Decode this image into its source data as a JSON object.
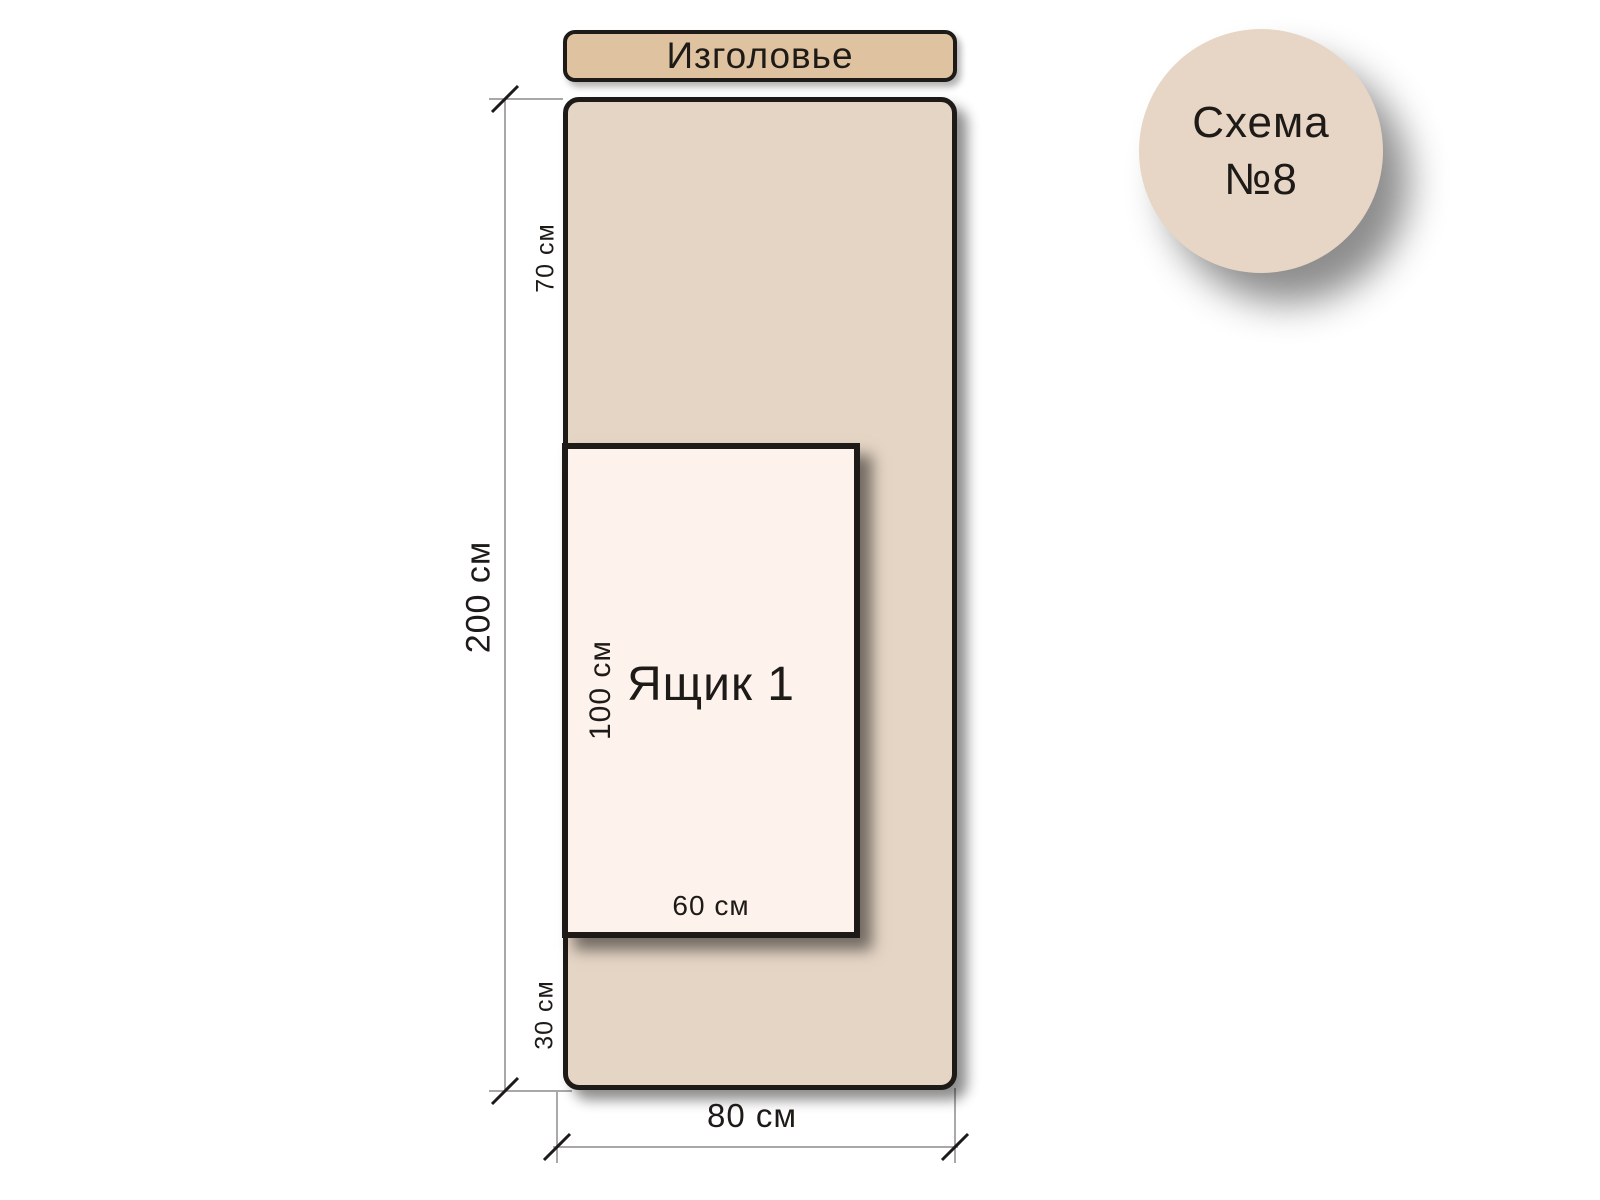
{
  "badge": {
    "line1": "Схема",
    "line2": "№8"
  },
  "headboard": {
    "label": "Изголовье"
  },
  "bed": {
    "length_label": "200 см",
    "width_label": "80 см",
    "head_offset_label": "70 см",
    "foot_offset_label": "30 см"
  },
  "drawer": {
    "label": "Ящик 1",
    "length_label": "100 см",
    "width_label": "60 см"
  },
  "colors": {
    "headboard_fill": "#dfc2a0",
    "bed_fill": "#e5d5c5",
    "drawer_fill": "#fdf3ec",
    "badge_fill": "#e7d6c5",
    "outline": "#1d1a17",
    "dim_line": "#8c8c8c"
  }
}
